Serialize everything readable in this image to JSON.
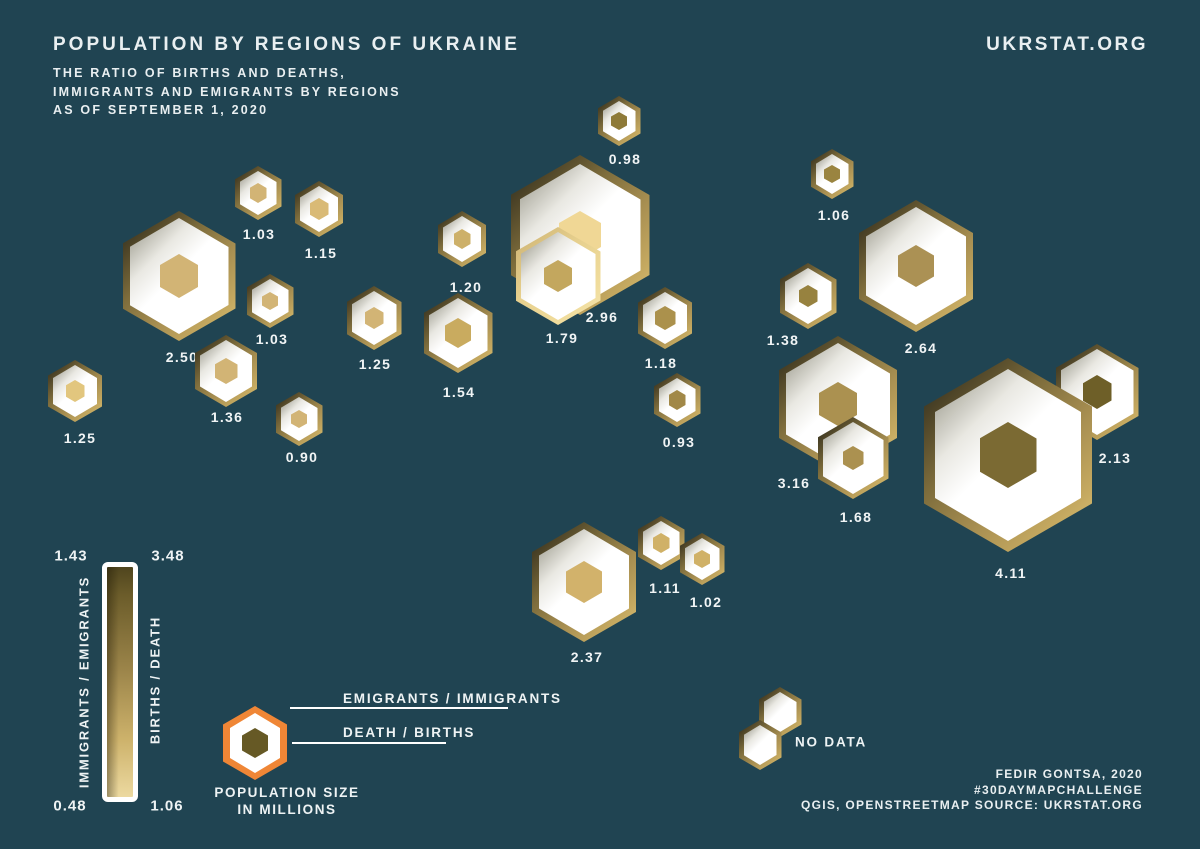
{
  "header": {
    "title": "POPULATION BY REGIONS OF UKRAINE",
    "subtitle_lines": [
      "THE RATIO OF BIRTHS AND DEATHS,",
      "IMMIGRANTS AND EMIGRANTS BY REGIONS",
      "AS OF SEPTEMBER 1, 2020"
    ],
    "site": "UKRSTAT.ORG"
  },
  "map": {
    "hex_ring_gradient": [
      "#4a4126",
      "#a99052",
      "#dcc67c"
    ],
    "hex_ring_cream": "#f0dc9c",
    "regions": [
      {
        "value": "2.50",
        "x": 179,
        "y": 276,
        "r": 65,
        "core": "#d2b475",
        "core_r": 22,
        "lx": 182,
        "ly": 357
      },
      {
        "value": "1.03",
        "x": 258,
        "y": 193,
        "r": 27,
        "core": "#d2b475",
        "core_r": 10,
        "lx": 259,
        "ly": 234
      },
      {
        "value": "1.15",
        "x": 319,
        "y": 209,
        "r": 28,
        "core": "#d9ba76",
        "core_r": 11,
        "lx": 321,
        "ly": 253
      },
      {
        "value": "1.03",
        "x": 270,
        "y": 301,
        "r": 27,
        "core": "#d2b475",
        "core_r": 9,
        "lx": 272,
        "ly": 339
      },
      {
        "value": "1.25",
        "x": 374,
        "y": 318,
        "r": 32,
        "core": "#d2b475",
        "core_r": 11,
        "lx": 375,
        "ly": 364
      },
      {
        "value": "1.54",
        "x": 458,
        "y": 333,
        "r": 40,
        "core": "#c9ab5f",
        "core_r": 15,
        "lx": 459,
        "ly": 392
      },
      {
        "value": "1.20",
        "x": 462,
        "y": 239,
        "r": 28,
        "core": "#cdb069",
        "core_r": 10,
        "lx": 466,
        "ly": 287
      },
      {
        "value": "0.98",
        "x": 619,
        "y": 121,
        "r": 25,
        "core": "#8e7a38",
        "core_r": 9,
        "lx": 625,
        "ly": 159
      },
      {
        "value": "2.96",
        "x": 580,
        "y": 235,
        "r": 80,
        "core": "#f0d795",
        "core_r": 24,
        "lx": 602,
        "ly": 317
      },
      {
        "value": "1.79",
        "x": 558,
        "y": 276,
        "r": 49,
        "ring": "cream",
        "core": "#c3a75e",
        "core_r": 16,
        "lx": 562,
        "ly": 338
      },
      {
        "value": "1.18",
        "x": 665,
        "y": 318,
        "r": 31,
        "core": "#ab914c",
        "core_r": 12,
        "lx": 661,
        "ly": 363
      },
      {
        "value": "0.93",
        "x": 677,
        "y": 400,
        "r": 27,
        "core": "#a18847",
        "core_r": 10,
        "lx": 679,
        "ly": 442
      },
      {
        "value": "1.25",
        "x": 75,
        "y": 391,
        "r": 31,
        "core": "#e2c67e",
        "core_r": 11,
        "lx": 80,
        "ly": 438
      },
      {
        "value": "1.36",
        "x": 226,
        "y": 371,
        "r": 36,
        "core": "#d2b475",
        "core_r": 13,
        "lx": 227,
        "ly": 417
      },
      {
        "value": "0.90",
        "x": 299,
        "y": 419,
        "r": 27,
        "core": "#d2b475",
        "core_r": 9,
        "lx": 302,
        "ly": 457
      },
      {
        "value": "1.06",
        "x": 832,
        "y": 174,
        "r": 25,
        "core": "#9a8440",
        "core_r": 9,
        "lx": 834,
        "ly": 215
      },
      {
        "value": "1.38",
        "x": 808,
        "y": 296,
        "r": 33,
        "core": "#97823f",
        "core_r": 11,
        "lx": 783,
        "ly": 340
      },
      {
        "value": "2.64",
        "x": 916,
        "y": 266,
        "r": 66,
        "core": "#ab9154",
        "core_r": 21,
        "lx": 921,
        "ly": 348
      },
      {
        "value": "3.16",
        "x": 838,
        "y": 404,
        "r": 68,
        "core": "#ab9150",
        "core_r": 22,
        "lx": 794,
        "ly": 483
      },
      {
        "value": "1.68",
        "x": 853,
        "y": 458,
        "r": 41,
        "core": "#ab9150",
        "core_r": 12,
        "lx": 856,
        "ly": 517
      },
      {
        "value": "2.13",
        "x": 1097,
        "y": 392,
        "r": 48,
        "core": "#6e5f28",
        "core_r": 17,
        "lx": 1115,
        "ly": 458
      },
      {
        "value": "4.11",
        "x": 1008,
        "y": 455,
        "r": 97,
        "core": "#7b6a33",
        "core_r": 33,
        "lx": 1011,
        "ly": 573
      },
      {
        "value": "2.37",
        "x": 584,
        "y": 582,
        "r": 60,
        "core": "#d2b26b",
        "core_r": 21,
        "lx": 587,
        "ly": 657
      },
      {
        "value": "1.11",
        "x": 661,
        "y": 543,
        "r": 27,
        "core": "#d0b167",
        "core_r": 10,
        "lx": 665,
        "ly": 588
      },
      {
        "value": "1.02",
        "x": 702,
        "y": 559,
        "r": 26,
        "core": "#d0b167",
        "core_r": 9,
        "lx": 706,
        "ly": 602
      },
      {
        "value": "",
        "x": 780,
        "y": 712,
        "r": 25
      },
      {
        "value": "",
        "x": 760,
        "y": 745,
        "r": 25
      }
    ],
    "no_data_label": "NO DATA"
  },
  "legend": {
    "scale_bar": {
      "left_top_value": "1.43",
      "right_top_value": "3.48",
      "left_bottom_value": "0.48",
      "right_bottom_value": "1.06",
      "left_axis_label": "IMMIGRANTS / EMIGRANTS",
      "right_axis_label": "BIRTHS / DEATH",
      "gradient_top_color": "#4f451e",
      "gradient_bottom_color": "#ecd9a0"
    },
    "hex_key": {
      "ring_label": "EMIGRANTS / IMMIGRANTS",
      "core_label": "DEATH / BIRTHS",
      "size_label_line1": "POPULATION SIZE",
      "size_label_line2": "IN MILLIONS",
      "ring_color": "#ef8636",
      "core_color": "#665925"
    }
  },
  "footer": {
    "credits": [
      "FEDIR GONTSA, 2020",
      "#30DAYMAPCHALLENGE",
      "QGIS, OPENSTREETMAP SOURCE: UKRSTAT.ORG"
    ]
  },
  "colors": {
    "background": "#204452",
    "text": "#e9eff1"
  }
}
